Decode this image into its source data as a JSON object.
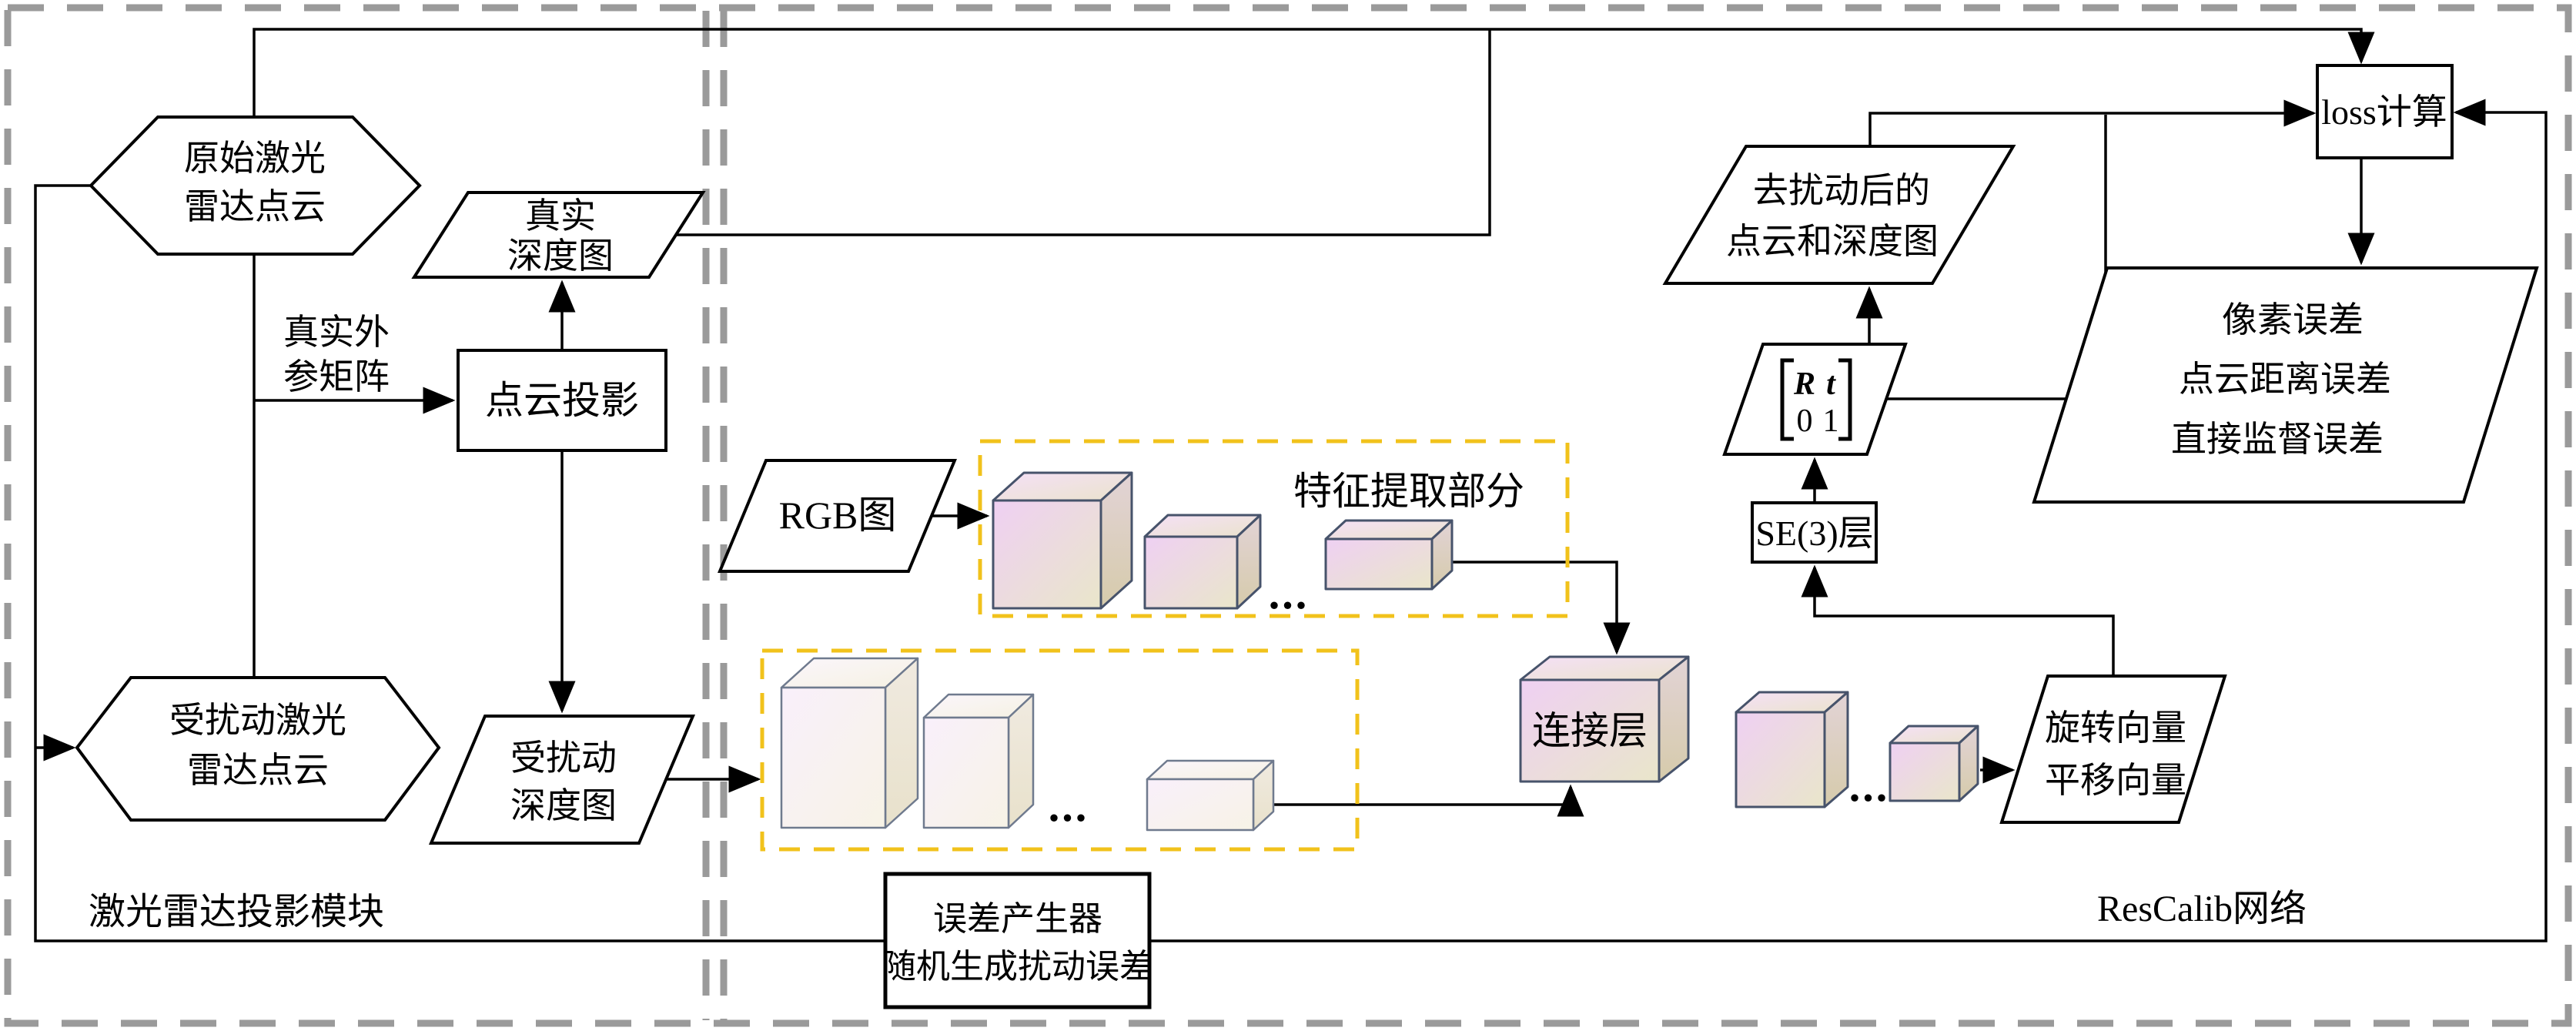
{
  "modules": {
    "lidar_projection_label": "激光雷达投影模块",
    "rescalib_label": "ResCalib网络",
    "error_generator": {
      "line1": "误差产生器",
      "line2": "随机生成扰动误差"
    }
  },
  "nodes": {
    "raw_cloud": {
      "line1": "原始激光",
      "line2": "雷达点云"
    },
    "true_depth": {
      "line1": "真实",
      "line2": "深度图"
    },
    "extrinsic_label": {
      "line1": "真实外",
      "line2": "参矩阵"
    },
    "cloud_projection": {
      "label": "点云投影"
    },
    "perturbed_cloud": {
      "line1": "受扰动激光",
      "line2": "雷达点云"
    },
    "perturbed_depth": {
      "line1": "受扰动",
      "line2": "深度图"
    },
    "rgb": {
      "label": "RGB图"
    },
    "feature_extraction_label": "特征提取部分",
    "concat_layer": {
      "label": "连接层"
    },
    "vectors": {
      "line1": "旋转向量",
      "line2": "平移向量"
    },
    "se3": {
      "label": "SE(3)层"
    },
    "matrix": {
      "r": "R",
      "t": "t",
      "zero": "0",
      "one": "1"
    },
    "deperturbed": {
      "line1": "去扰动后的",
      "line2": "点云和深度图"
    },
    "loss": {
      "label": "loss计算"
    },
    "errors": {
      "line1": "像素误差",
      "line2": "点云距离误差",
      "line3": "直接监督误差"
    },
    "ellipsis": "..."
  },
  "colors": {
    "accent_yellow_dash": "#f1c21b",
    "module_dash_gray": "#9a9a9a",
    "cube_border_dark": "#47536b",
    "cube_border_light": "#6f7a8e",
    "cube_front_pink": "#efd3f3",
    "cube_front_cream": "#eae6cb",
    "line_black": "#000000"
  }
}
